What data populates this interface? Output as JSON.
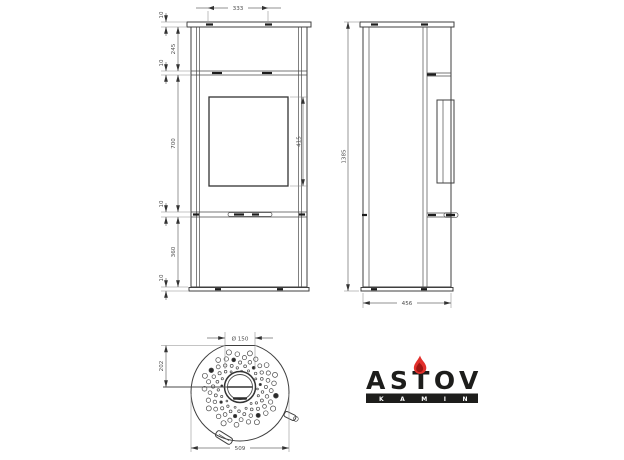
{
  "drawing_title": "stove-dimension-drawing",
  "colors": {
    "line": "#3f3f3f",
    "dim_line": "#6b6b6b",
    "dim_text": "#4d4d4d",
    "logo_black": "#1d1d1b",
    "flame_red": "#e2302c",
    "flame_dark_red": "#9e1512",
    "background": "#ffffff"
  },
  "front_view": {
    "top_width": "333",
    "top_plate_thickness": "10",
    "upper_panel_height": "245",
    "upper_seam": "10",
    "door_section_height": "700",
    "lower_seam": "10",
    "base_section_height": "360",
    "plinth_height": "10",
    "glass_height": "415"
  },
  "side_view": {
    "overall_height": "1385",
    "depth": "456"
  },
  "top_view": {
    "flue_diameter": "Ø 150",
    "flue_center_offset": "202",
    "body_diameter": "509"
  },
  "logo": {
    "brand": "ASTOV",
    "tagline": "KAMIN"
  }
}
